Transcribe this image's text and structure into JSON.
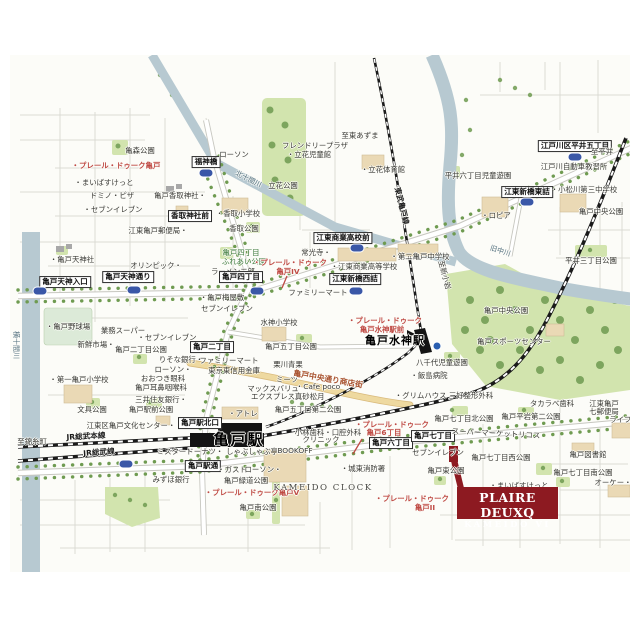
{
  "site": {
    "line1": "PLAIRE DEUXQ",
    "line2": "KAMEIDO VI"
  },
  "colors": {
    "brand_red": "#8d1a21",
    "poi_red": "#bf4a44",
    "river_blue": "#b7c9d1",
    "park_green": "#d2e4ae",
    "tree_green": "#6f9b51",
    "building_tan": "#ead9b5",
    "shop_street_yellow": "#eed9a0",
    "shield_blue": "#3a57a7",
    "rail_black": "#1a1a1a",
    "road_gray": "#c7c7c0"
  },
  "map": {
    "labels": [
      {
        "t": "亀森公園",
        "x": 140,
        "y": 151
      },
      {
        "t": "・プレール・ドゥーク亀戸",
        "x": 116,
        "y": 166,
        "c": "red",
        "n": "plaire-deuxq-kameido-label"
      },
      {
        "t": "・まいばすけっと",
        "x": 104,
        "y": 183
      },
      {
        "t": "ドミノ・ピザ",
        "x": 112,
        "y": 196
      },
      {
        "t": "・セブンイレブン",
        "x": 113,
        "y": 210
      },
      {
        "t": "福神橋",
        "x": 206,
        "y": 162,
        "c": "box",
        "n": "fukujinbashi-label"
      },
      {
        "x": 206,
        "y": 173,
        "c": "shield"
      },
      {
        "t": "ローソン",
        "x": 234,
        "y": 155
      },
      {
        "t": "北十間川",
        "x": 248,
        "y": 180,
        "c": "river",
        "r": 27,
        "n": "kitajukken-river-label"
      },
      {
        "t": "亀戸香取神社・",
        "x": 180,
        "y": 196
      },
      {
        "t": "香取神社前",
        "x": 190,
        "y": 216,
        "c": "box"
      },
      {
        "t": "・香取小学校",
        "x": 238,
        "y": 214
      },
      {
        "t": "香取公園",
        "x": 244,
        "y": 229
      },
      {
        "t": "江東亀戸郵便局・",
        "x": 158,
        "y": 231
      },
      {
        "t": "・亀戸天神社",
        "x": 72,
        "y": 260
      },
      {
        "t": "フレンドリープラザ",
        "x": 315,
        "y": 146
      },
      {
        "t": "・立花児童館",
        "x": 309,
        "y": 155
      },
      {
        "t": "立花公園",
        "x": 283,
        "y": 186
      },
      {
        "t": "至東あずま",
        "x": 360,
        "y": 136
      },
      {
        "t": "・立花体育館",
        "x": 383,
        "y": 170
      },
      {
        "t": "東武亀戸線",
        "x": 401,
        "y": 206,
        "c": "rail",
        "r": 76,
        "n": "tobu-kameido-line-label"
      },
      {
        "t": "江戸川区平井五丁目",
        "x": 575,
        "y": 146,
        "c": "box"
      },
      {
        "x": 575,
        "y": 157,
        "c": "shield"
      },
      {
        "t": "至平井",
        "x": 602,
        "y": 152
      },
      {
        "t": "江戸川自動車教習所",
        "x": 574,
        "y": 167
      },
      {
        "t": "平井六丁目児童遊園",
        "x": 478,
        "y": 176
      },
      {
        "t": "江東新橋東詰",
        "x": 527,
        "y": 192,
        "c": "box"
      },
      {
        "x": 527,
        "y": 202,
        "c": "shield"
      },
      {
        "t": "・小松川第三中学校",
        "x": 584,
        "y": 190
      },
      {
        "t": "・ロピア",
        "x": 496,
        "y": 216
      },
      {
        "t": "旧中川",
        "x": 500,
        "y": 252,
        "c": "river",
        "r": 18,
        "n": "kyu-nakagawa-river-label"
      },
      {
        "t": "平井三丁目公園",
        "x": 591,
        "y": 261
      },
      {
        "t": "亀戸中央公園",
        "x": 601,
        "y": 212
      },
      {
        "t": "亀戸中央公園",
        "x": 506,
        "y": 311,
        "n": "kameido-chuo-park-label"
      },
      {
        "t": "亀戸スポーツセンター",
        "x": 514,
        "y": 342
      },
      {
        "t": "オリンピック・",
        "x": 156,
        "y": 266
      },
      {
        "t": "亀戸四丁目",
        "x": 241,
        "y": 253,
        "c": "green"
      },
      {
        "t": "ふれあい公園",
        "x": 244,
        "y": 262,
        "c": "green"
      },
      {
        "t": "ラーメン二郎",
        "x": 233,
        "y": 272
      },
      {
        "t": "亀戸天神入口",
        "x": 65,
        "y": 282,
        "c": "box"
      },
      {
        "x": 40,
        "y": 291,
        "c": "shield"
      },
      {
        "t": "亀戸天神通り",
        "x": 128,
        "y": 277,
        "c": "box"
      },
      {
        "x": 134,
        "y": 290,
        "c": "shield"
      },
      {
        "t": "亀戸四丁目",
        "x": 241,
        "y": 277,
        "c": "box"
      },
      {
        "x": 257,
        "y": 291,
        "c": "shield"
      },
      {
        "t": "・プレール・ドゥーク",
        "x": 290,
        "y": 263,
        "c": "red"
      },
      {
        "t": "亀戸IV",
        "x": 288,
        "y": 272,
        "c": "red"
      },
      {
        "t": "常光寺・",
        "x": 316,
        "y": 253
      },
      {
        "t": "江東商業高校前",
        "x": 343,
        "y": 238,
        "c": "box"
      },
      {
        "x": 357,
        "y": 248,
        "c": "shield"
      },
      {
        "t": "・江東商業高等学校",
        "x": 364,
        "y": 267
      },
      {
        "t": "・第二亀戸中学校",
        "x": 420,
        "y": 257
      },
      {
        "t": "江東新橋西詰",
        "x": 355,
        "y": 279,
        "c": "box"
      },
      {
        "x": 356,
        "y": 291,
        "c": "shield"
      },
      {
        "t": "至新小岩",
        "x": 444,
        "y": 275,
        "r": 75
      },
      {
        "t": "ファミリーマート",
        "x": 318,
        "y": 293
      },
      {
        "t": "・亀戸梅屋敷",
        "x": 222,
        "y": 298
      },
      {
        "t": "セブンイレブン",
        "x": 227,
        "y": 309
      },
      {
        "t": "業務スーパー",
        "x": 123,
        "y": 331
      },
      {
        "t": "・セブンイレブン",
        "x": 167,
        "y": 338
      },
      {
        "t": "新鮮市場・",
        "x": 96,
        "y": 345
      },
      {
        "t": "亀戸二丁目公園",
        "x": 141,
        "y": 350
      },
      {
        "t": "・亀戸野球場",
        "x": 68,
        "y": 327
      },
      {
        "t": "りそな銀行・",
        "x": 181,
        "y": 360
      },
      {
        "t": "ローソン・",
        "x": 173,
        "y": 370
      },
      {
        "t": "おおつき眼科",
        "x": 163,
        "y": 379
      },
      {
        "t": "亀戸耳鼻咽喉科",
        "x": 161,
        "y": 388
      },
      {
        "t": "三井住友銀行・",
        "x": 161,
        "y": 400
      },
      {
        "t": "・第一亀戸小学校",
        "x": 79,
        "y": 380
      },
      {
        "t": "亀戸二丁目",
        "x": 212,
        "y": 347,
        "c": "box"
      },
      {
        "t": "ファミリーマート",
        "x": 229,
        "y": 361
      },
      {
        "t": "東京東信用金庫",
        "x": 234,
        "y": 371
      },
      {
        "t": "水神小学校",
        "x": 279,
        "y": 323
      },
      {
        "t": "亀戸五丁目公園",
        "x": 291,
        "y": 347
      },
      {
        "t": "栗川青果",
        "x": 288,
        "y": 365
      },
      {
        "t": "ミーツ",
        "x": 287,
        "y": 380
      },
      {
        "t": "マックスバリュ",
        "x": 273,
        "y": 389
      },
      {
        "t": "エクスプレス",
        "x": 273,
        "y": 397
      },
      {
        "t": "亀戸中央通り商店街",
        "x": 328,
        "y": 380,
        "c": "street",
        "r": 10,
        "n": "shopping-street-label"
      },
      {
        "t": "・Cafe poco",
        "x": 318,
        "y": 387
      },
      {
        "t": "・真砂松月",
        "x": 306,
        "y": 397
      },
      {
        "t": "亀戸五丁目第二公園",
        "x": 308,
        "y": 410
      },
      {
        "t": "・プレール・ドゥーク",
        "x": 385,
        "y": 321,
        "c": "red"
      },
      {
        "t": "亀戸水神駅前",
        "x": 382,
        "y": 330,
        "c": "red"
      },
      {
        "t": "亀戸水神駅",
        "x": 395,
        "y": 341,
        "c": "bold-md",
        "n": "kameido-suijin-station-label"
      },
      {
        "x": 437,
        "y": 346,
        "c": "dot"
      },
      {
        "t": "八千代児童遊園",
        "x": 442,
        "y": 363
      },
      {
        "t": "・飯島病院",
        "x": 429,
        "y": 376
      },
      {
        "t": "・グリムハウス 三好整形外科",
        "x": 444,
        "y": 396
      },
      {
        "t": "・アトレ",
        "x": 243,
        "y": 414
      },
      {
        "t": "亀戸駅北口",
        "x": 200,
        "y": 423,
        "c": "box"
      },
      {
        "t": "亀戸駅",
        "x": 239,
        "y": 440,
        "c": "bold-lg",
        "n": "kameido-station-label"
      },
      {
        "t": "JR総武本線",
        "x": 86,
        "y": 437,
        "c": "rail",
        "r": -3,
        "n": "jr-sobu-main-line-label"
      },
      {
        "t": "JR総武線",
        "x": 99,
        "y": 453,
        "c": "rail",
        "r": -4,
        "n": "jr-sobu-line-label"
      },
      {
        "t": "至錦糸町",
        "x": 32,
        "y": 442
      },
      {
        "t": "ミスタードーナツ・",
        "x": 190,
        "y": 452
      },
      {
        "t": "しゃぶしゃぶ亭",
        "x": 252,
        "y": 452
      },
      {
        "t": "亀戸駅通",
        "x": 203,
        "y": 466,
        "c": "box"
      },
      {
        "x": 126,
        "y": 464,
        "c": "shield"
      },
      {
        "t": "・ガスト",
        "x": 232,
        "y": 470
      },
      {
        "t": "ローソン・",
        "x": 263,
        "y": 470
      },
      {
        "t": "みずほ銀行",
        "x": 171,
        "y": 480
      },
      {
        "t": "亀戸緑道公園",
        "x": 246,
        "y": 481
      },
      {
        "t": "・プレール・ドゥーク亀戸V",
        "x": 252,
        "y": 493,
        "c": "red"
      },
      {
        "t": "亀戸南公園",
        "x": 258,
        "y": 508
      },
      {
        "t": "KAMEIDO CLOCK",
        "x": 323,
        "y": 489,
        "c": "caps",
        "n": "kameido-clock-label"
      },
      {
        "t": "文具公園",
        "x": 92,
        "y": 410
      },
      {
        "t": "亀戸駅前公園",
        "x": 151,
        "y": 410
      },
      {
        "t": "江東区亀戸文化センター・",
        "x": 131,
        "y": 426
      },
      {
        "t": "小林歯科・口腔外科",
        "x": 328,
        "y": 433
      },
      {
        "t": "クリニック",
        "x": 321,
        "y": 440
      },
      {
        "t": "BOOKOFF",
        "x": 295,
        "y": 451
      },
      {
        "t": "・プレール・ドゥーク",
        "x": 392,
        "y": 425,
        "c": "red"
      },
      {
        "t": "亀戸6丁目",
        "x": 384,
        "y": 433,
        "c": "red"
      },
      {
        "t": "亀戸六丁目",
        "x": 391,
        "y": 443,
        "c": "box"
      },
      {
        "t": "亀戸七丁目",
        "x": 433,
        "y": 436,
        "c": "box"
      },
      {
        "t": "セブンイレブン",
        "x": 438,
        "y": 453
      },
      {
        "t": "・城東消防署",
        "x": 363,
        "y": 469
      },
      {
        "t": "亀戸東公園",
        "x": 446,
        "y": 471
      },
      {
        "t": "タカラベ歯科",
        "x": 552,
        "y": 404
      },
      {
        "t": "江東亀戸",
        "x": 604,
        "y": 404
      },
      {
        "t": "七郵便局",
        "x": 604,
        "y": 412
      },
      {
        "t": "亀戸七丁目北公園",
        "x": 464,
        "y": 419
      },
      {
        "t": "亀戸平岩第二公園",
        "x": 531,
        "y": 417
      },
      {
        "t": "スーパーマーケットリコス",
        "x": 496,
        "y": 434,
        "r": 3
      },
      {
        "t": "ライフ・",
        "x": 624,
        "y": 420
      },
      {
        "t": "亀戸図書館",
        "x": 588,
        "y": 455
      },
      {
        "t": "亀戸七丁目西公園",
        "x": 501,
        "y": 458
      },
      {
        "t": "亀戸七丁目南公園",
        "x": 583,
        "y": 473
      },
      {
        "t": "・まいばすけっと",
        "x": 519,
        "y": 486
      },
      {
        "t": "オーケー・",
        "x": 613,
        "y": 483
      },
      {
        "t": "・プレール・ドゥーク",
        "x": 412,
        "y": 499,
        "c": "red"
      },
      {
        "t": "亀戸II",
        "x": 425,
        "y": 508,
        "c": "red"
      },
      {
        "t": "横十間川",
        "x": 15,
        "y": 345,
        "c": "river",
        "r": 90,
        "n": "yokojukken-river-label"
      }
    ]
  }
}
